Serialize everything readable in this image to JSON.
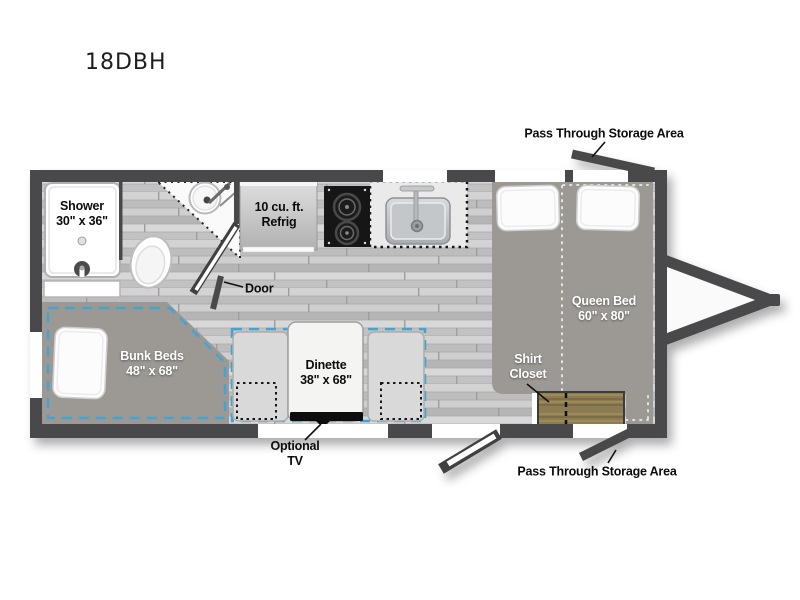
{
  "model": "18DBH",
  "colors": {
    "wall": "#4a4a4c",
    "floorplan_accent_dash": "#44a3d4",
    "closet_wood": "#8b7b53",
    "bed_gray": "#9c9995"
  },
  "labels": {
    "pass_through_storage_top": "Pass Through Storage Area",
    "pass_through_storage_bottom": "Pass Through Storage Area",
    "shower_line1": "Shower",
    "shower_line2": "30\" x 36\"",
    "refrig_line1": "10 cu. ft.",
    "refrig_line2": "Refrig",
    "door": "Door",
    "queen_bed_line1": "Queen Bed",
    "queen_bed_line2": "60\" x 80\"",
    "shirt_closet_line1": "Shirt",
    "shirt_closet_line2": "Closet",
    "bunk_beds_line1": "Bunk Beds",
    "bunk_beds_line2": "48\" x 68\"",
    "dinette_line1": "Dinette",
    "dinette_line2": "38\" x 68\"",
    "optional_tv_line1": "Optional",
    "optional_tv_line2": "TV"
  }
}
